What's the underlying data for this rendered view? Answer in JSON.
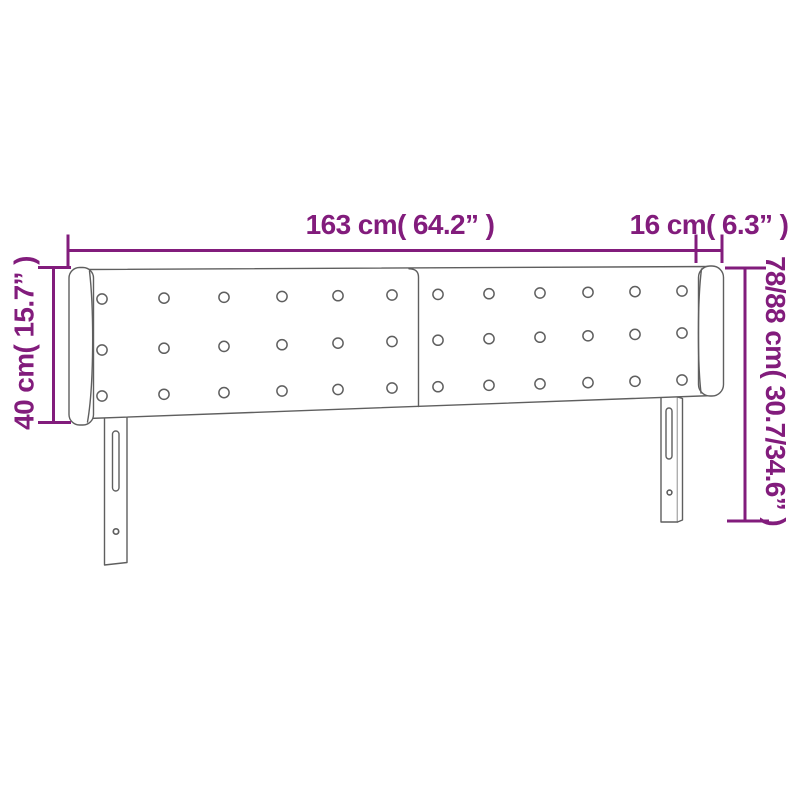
{
  "diagram": {
    "labels": {
      "total_width": "163 cm( 64.2” )",
      "wing_depth": "16 cm( 6.3” )",
      "panel_height": "40 cm( 15.7” )",
      "total_height": "78/88 cm( 30.7/34.6” )"
    },
    "colors": {
      "dimension": "#821c7c",
      "outline": "#5f5f5f",
      "background": "#ffffff"
    }
  }
}
